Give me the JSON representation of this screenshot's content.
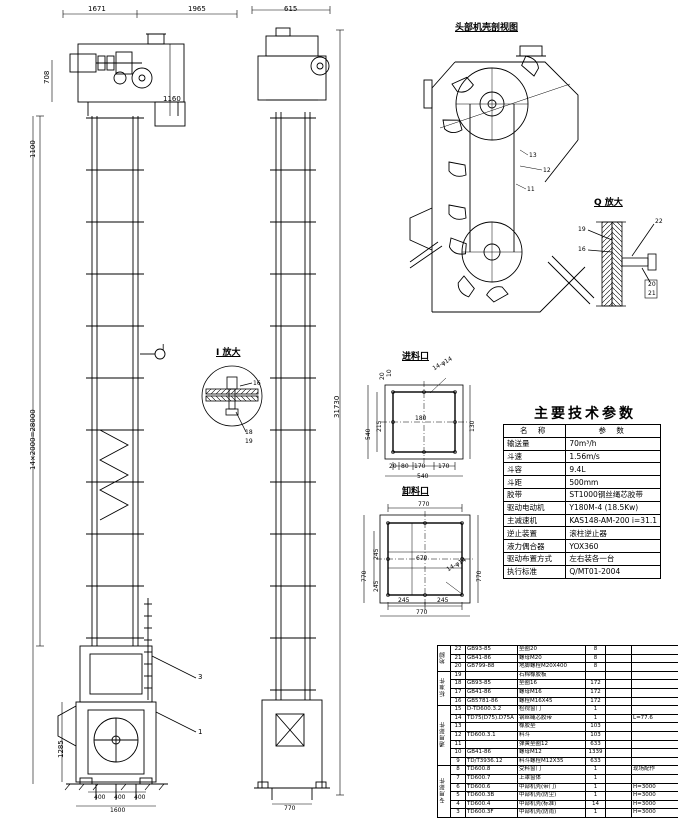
{
  "accent_colors": {
    "line": "#000000",
    "paper": "#ffffff"
  },
  "params_table": {
    "title": "主要技术参数",
    "header": [
      "名  称",
      "参  数"
    ],
    "rows": [
      [
        "输送量",
        "70m³/h"
      ],
      [
        "斗速",
        "1.56m/s"
      ],
      [
        "斗容",
        "9.4L"
      ],
      [
        "斗距",
        "500mm"
      ],
      [
        "胶带",
        "ST1000钢丝绳芯胶带"
      ],
      [
        "驱动电动机",
        "Y180M-4 (18.5Kw)"
      ],
      [
        "主减速机",
        "KAS148-AM-200 i=31.1"
      ],
      [
        "逆止装置",
        "滚柱逆止器"
      ],
      [
        "液力偶合器",
        "YOX360"
      ],
      [
        "驱动布置方式",
        "左右装各一台"
      ],
      [
        "执行标准",
        "Q/MT01-2004"
      ]
    ]
  },
  "bom_table": {
    "groups": [
      {
        "label": "地脚",
        "span": 3
      },
      {
        "label": "标准件",
        "span": 4
      },
      {
        "label": "通用部件",
        "span": 7
      },
      {
        "label": "专用部件",
        "span": 6
      }
    ],
    "rows": [
      [
        "22",
        "GB93-85",
        "垫圈20",
        "8",
        ""
      ],
      [
        "21",
        "GB41-86",
        "螺母M20",
        "8",
        ""
      ],
      [
        "20",
        "GB799-88",
        "地脚螺栓M20X400",
        "8",
        ""
      ],
      [
        "19",
        "",
        "石棉橡胶板",
        "",
        ""
      ],
      [
        "18",
        "GB93-85",
        "垫圈16",
        "172",
        ""
      ],
      [
        "17",
        "GB41-86",
        "螺母M16",
        "172",
        ""
      ],
      [
        "16",
        "GB5781-86",
        "螺栓M16X45",
        "172",
        ""
      ],
      [
        "15",
        "D-TD600.3.2",
        "检视窗门",
        "1",
        ""
      ],
      [
        "14",
        "TD75(D75).D75A",
        "钢丝绳芯胶带",
        "1",
        "L=77.6"
      ],
      [
        "13",
        "",
        "橡胶垫",
        "103",
        ""
      ],
      [
        "12",
        "TD600.3.1",
        "料斗",
        "103",
        ""
      ],
      [
        "11",
        "",
        "弹簧垫圈12",
        "633",
        ""
      ],
      [
        "10",
        "GB41-86",
        "螺母M12",
        "1339",
        ""
      ],
      [
        "9",
        "TD/T3936.12",
        "料斗螺栓M12X35",
        "633",
        ""
      ],
      [
        "8",
        "TD600.8",
        "受料窗门",
        "1",
        "现场配作"
      ],
      [
        "7",
        "TD600.7",
        "上罩窗体",
        "1",
        ""
      ],
      [
        "6",
        "TD600.6",
        "中部机壳(带门)",
        "1",
        "H=3000"
      ],
      [
        "5",
        "TD600.3B",
        "中部机壳(防尘)",
        "1",
        "H=3000"
      ],
      [
        "4",
        "TD600.4",
        "中部机壳(标准)",
        "14",
        "H=3000"
      ],
      [
        "3",
        "TD600.3F",
        "中部机壳(防雨)",
        "1",
        "H=3000"
      ]
    ]
  },
  "labels": [
    {
      "t": "1671",
      "x": 88,
      "y": 6,
      "s": 7
    },
    {
      "t": "1965",
      "x": 188,
      "y": 6,
      "s": 7
    },
    {
      "t": "615",
      "x": 284,
      "y": 6,
      "s": 7
    },
    {
      "t": "708",
      "x": 44,
      "y": 84,
      "r": -90,
      "s": 7
    },
    {
      "t": "1160",
      "x": 163,
      "y": 96,
      "s": 7
    },
    {
      "t": "1100",
      "x": 30,
      "y": 158,
      "r": -90,
      "s": 7
    },
    {
      "t": "14×2000=28000",
      "x": 30,
      "y": 470,
      "r": -90,
      "s": 7
    },
    {
      "t": "31730",
      "x": 334,
      "y": 418,
      "r": -90,
      "s": 7
    },
    {
      "t": "1285",
      "x": 58,
      "y": 758,
      "r": -90,
      "s": 7
    },
    {
      "t": "400",
      "x": 94,
      "y": 795,
      "s": 6
    },
    {
      "t": "400",
      "x": 114,
      "y": 795,
      "s": 6
    },
    {
      "t": "400",
      "x": 134,
      "y": 795,
      "s": 6
    },
    {
      "t": "1600",
      "x": 110,
      "y": 808,
      "s": 6
    },
    {
      "t": "770",
      "x": 284,
      "y": 806,
      "s": 6
    },
    {
      "t": "I",
      "x": 162,
      "y": 344,
      "s": 8
    },
    {
      "t": "3",
      "x": 198,
      "y": 674,
      "s": 7
    },
    {
      "t": "1",
      "x": 198,
      "y": 729,
      "s": 7
    },
    {
      "t": "I 放大",
      "x": 216,
      "y": 349,
      "s": 9,
      "u": 1
    },
    {
      "t": "16",
      "x": 253,
      "y": 381,
      "s": 6
    },
    {
      "t": "18",
      "x": 245,
      "y": 430,
      "s": 6
    },
    {
      "t": "19",
      "x": 245,
      "y": 439,
      "s": 6
    },
    {
      "t": "Q 放大",
      "x": 594,
      "y": 199,
      "s": 9,
      "u": 1
    },
    {
      "t": "19",
      "x": 578,
      "y": 227,
      "s": 6
    },
    {
      "t": "16",
      "x": 578,
      "y": 247,
      "s": 6
    },
    {
      "t": "22",
      "x": 655,
      "y": 219,
      "s": 6
    },
    {
      "t": "20",
      "x": 648,
      "y": 282,
      "s": 6
    },
    {
      "t": "21",
      "x": 648,
      "y": 291,
      "s": 6
    },
    {
      "t": "头部机壳剖视图",
      "x": 455,
      "y": 24,
      "s": 9,
      "u": 1
    },
    {
      "t": "13",
      "x": 529,
      "y": 153,
      "s": 6
    },
    {
      "t": "12",
      "x": 543,
      "y": 168,
      "s": 6
    },
    {
      "t": "11",
      "x": 527,
      "y": 187,
      "s": 6
    },
    {
      "t": "进料口",
      "x": 402,
      "y": 353,
      "s": 9,
      "u": 1
    },
    {
      "t": "14-φ14",
      "x": 432,
      "y": 367,
      "s": 6,
      "r": -30
    },
    {
      "t": "20",
      "x": 380,
      "y": 380,
      "r": -90,
      "s": 6
    },
    {
      "t": "10",
      "x": 387,
      "y": 377,
      "r": -90,
      "s": 6
    },
    {
      "t": "215",
      "x": 377,
      "y": 432,
      "r": -90,
      "s": 6
    },
    {
      "t": "540",
      "x": 366,
      "y": 440,
      "r": -90,
      "s": 6
    },
    {
      "t": "180",
      "x": 415,
      "y": 416,
      "s": 6
    },
    {
      "t": "130",
      "x": 470,
      "y": 432,
      "r": -90,
      "s": 6
    },
    {
      "t": "20",
      "x": 389,
      "y": 464,
      "s": 6
    },
    {
      "t": "80",
      "x": 401,
      "y": 464,
      "s": 6
    },
    {
      "t": "170",
      "x": 414,
      "y": 464,
      "s": 6
    },
    {
      "t": "170",
      "x": 438,
      "y": 464,
      "s": 6
    },
    {
      "t": "540",
      "x": 417,
      "y": 474,
      "s": 6
    },
    {
      "t": "卸料口",
      "x": 402,
      "y": 488,
      "s": 9,
      "u": 1
    },
    {
      "t": "770",
      "x": 418,
      "y": 502,
      "s": 6
    },
    {
      "t": "245",
      "x": 374,
      "y": 560,
      "r": -90,
      "s": 6
    },
    {
      "t": "245",
      "x": 374,
      "y": 592,
      "r": -90,
      "s": 6
    },
    {
      "t": "770",
      "x": 362,
      "y": 582,
      "r": -90,
      "s": 6
    },
    {
      "t": "770",
      "x": 477,
      "y": 582,
      "r": -90,
      "s": 6
    },
    {
      "t": "670",
      "x": 416,
      "y": 556,
      "s": 6
    },
    {
      "t": "14-φ14",
      "x": 446,
      "y": 568,
      "s": 6,
      "r": -30
    },
    {
      "t": "245",
      "x": 398,
      "y": 598,
      "s": 6
    },
    {
      "t": "245",
      "x": 437,
      "y": 598,
      "s": 6
    },
    {
      "t": "770",
      "x": 416,
      "y": 610,
      "s": 6
    }
  ]
}
